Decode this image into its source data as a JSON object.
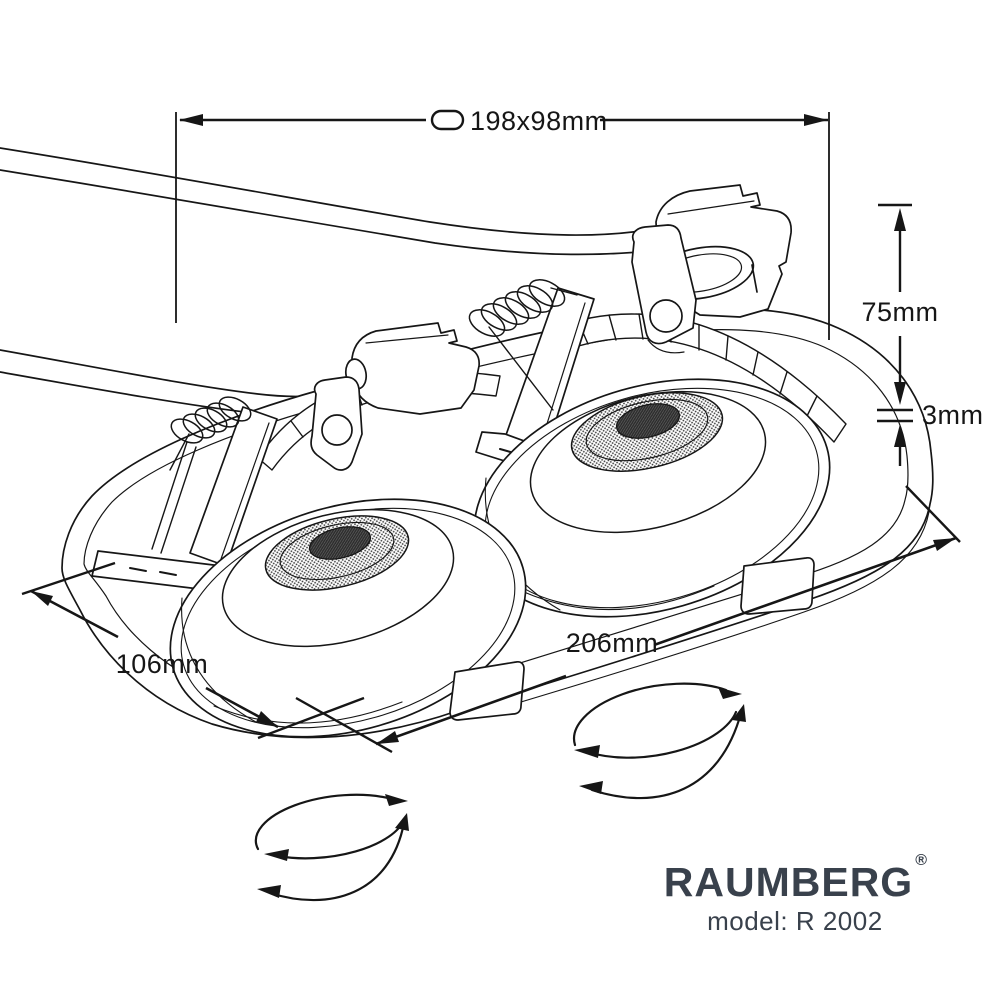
{
  "drawing": {
    "dim_cutout": "198x98mm",
    "dim_height": "75mm",
    "dim_rim": "3mm",
    "dim_width": "106mm",
    "dim_length": "206mm"
  },
  "brand": {
    "name": "RAUMBERG",
    "mark": "®",
    "model": "model: R 2002"
  },
  "icons": {
    "cutout": "oval-cutout-icon",
    "rotation": "rotation-arrows-icon"
  },
  "colors": {
    "line": "#161616",
    "brand_text": "#39414c",
    "background": "#ffffff"
  }
}
